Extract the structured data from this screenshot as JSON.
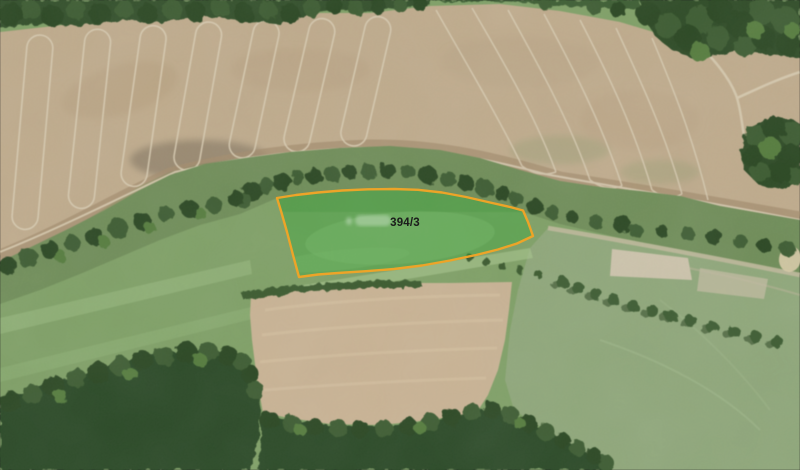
{
  "map": {
    "type": "aerial-orthophoto-with-cadastral-overlay",
    "parcel": {
      "label": "394/3",
      "label_color": "#1b1b1b",
      "outline_color": "#EDA428",
      "fill_color": "#35A93A",
      "fill_opacity": "0.38"
    }
  }
}
